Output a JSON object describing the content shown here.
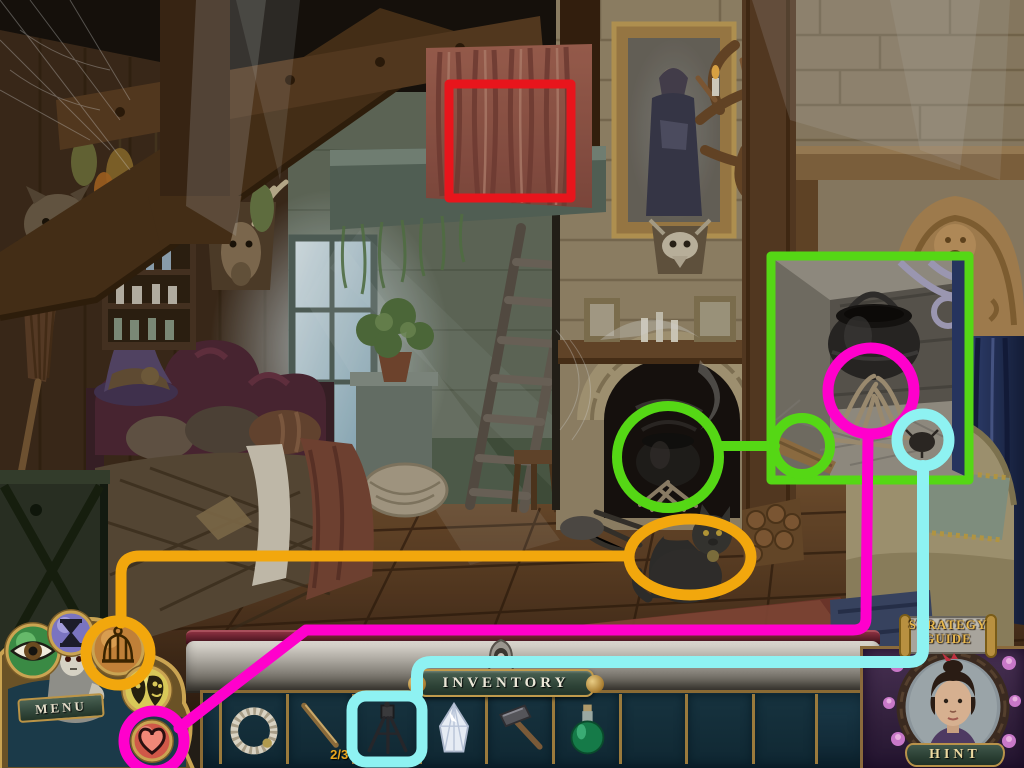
{
  "scene": {
    "name": "witch-cottage-room",
    "objects": [
      "loft-beams",
      "red-curtain",
      "gray-gauze",
      "window",
      "light-rays",
      "ladder",
      "potted-plant",
      "stone-chimney",
      "fireplace",
      "cauldron",
      "fire-kindling",
      "mantel",
      "portrait-painting",
      "animal-skull-mount",
      "antler-chandelier",
      "carved-crest",
      "blue-curtain",
      "armchair",
      "black-cat",
      "firewood-logs",
      "bed",
      "quilt",
      "witch-hat",
      "broom",
      "crate",
      "shelf-with-bottles",
      "wolf-head-mount",
      "deer-head-mount",
      "hanging-herbs",
      "stool",
      "basket"
    ]
  },
  "hud": {
    "menu": {
      "label": "MENU"
    },
    "inventory_banner": {
      "label": "INVENTORY"
    },
    "hint": {
      "label": "HINT"
    },
    "strategy_guide": {
      "line1": "STRATEGY",
      "line2": "GUIDE"
    },
    "buttons": [
      {
        "name": "eye"
      },
      {
        "name": "hourglass"
      },
      {
        "name": "birdcage"
      },
      {
        "name": "masks"
      },
      {
        "name": "heart"
      }
    ]
  },
  "inventory": {
    "slots": [
      {
        "item": "rope-ring"
      },
      {
        "item": "rod",
        "count": "2/3"
      },
      {
        "item": "tripod",
        "highlight": "cyan"
      },
      {
        "item": "crystal"
      },
      {
        "item": "hammer"
      },
      {
        "item": "green-potion"
      },
      {
        "item": null
      },
      {
        "item": null
      },
      {
        "item": null
      }
    ]
  },
  "annotations": {
    "colors": {
      "red": "#e8151c",
      "green": "#55d715",
      "magenta": "#ff00cc",
      "cyan": "#8ef2f2",
      "orange": "#f2a70d"
    },
    "shapes": [
      {
        "type": "rect",
        "color": "red",
        "target": "loft-curtain"
      },
      {
        "type": "circle",
        "color": "green",
        "target": "fireplace-cauldron"
      },
      {
        "type": "rect-inset",
        "color": "green",
        "target": "cauldron-closeup"
      },
      {
        "type": "circle-small",
        "color": "green",
        "target": "wood-stick"
      },
      {
        "type": "circle",
        "color": "magenta",
        "target": "fire-kindling",
        "links_to": "heart-button"
      },
      {
        "type": "circle",
        "color": "cyan",
        "target": "beetle",
        "links_to": "tripod-slot"
      },
      {
        "type": "ellipse",
        "color": "orange",
        "target": "black-cat",
        "links_to": "birdcage-button"
      }
    ]
  }
}
